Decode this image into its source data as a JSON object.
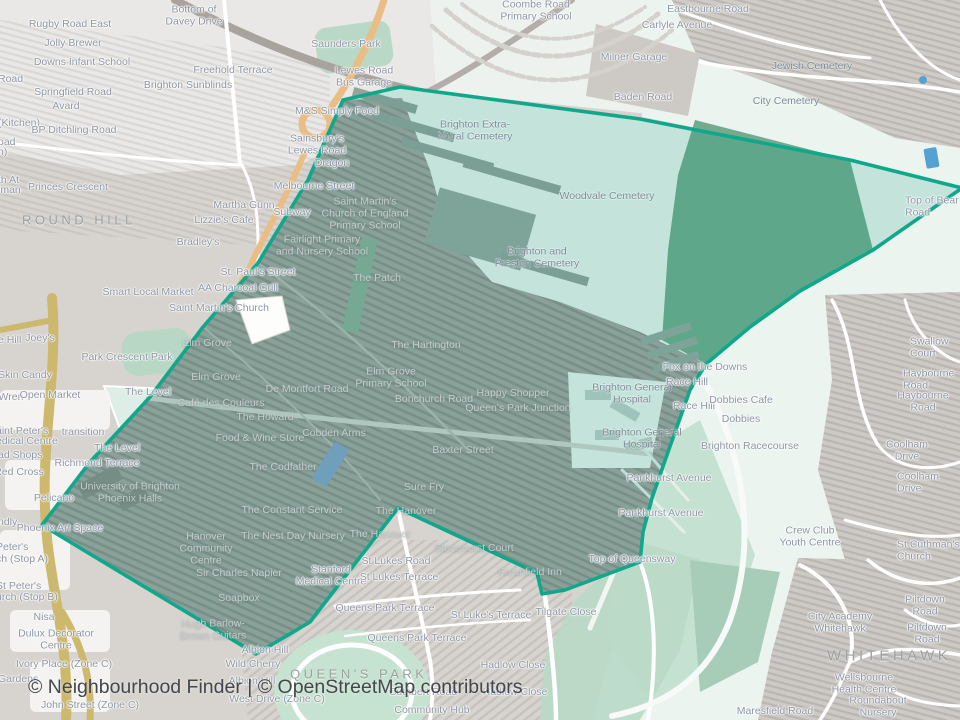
{
  "app": {
    "type": "neighbourhood-boundary-map",
    "attribution": "© Neighbourhood Finder | © OpenStreetMap contributors"
  },
  "colors": {
    "boundary_stroke": "#10a78b",
    "boundary_fill": "rgba(0,150,120,0.18)",
    "land_urban": "#d7d3cf",
    "land_open": "#ecf4f0",
    "woodland": "#74ab8e",
    "park_green": "#b9d9c6",
    "main_road_orange": "#e9bd83",
    "main_road_gold": "#cdb96d",
    "water_blue": "#6f9fba",
    "label_gray": "#8e96a3",
    "label_light": "#c6cdce",
    "attribution_text": "#43474b"
  },
  "map": {
    "district_labels": [
      {
        "t": "ROUND HILL",
        "x": 22,
        "y": 221,
        "c": "area",
        "a": "l"
      },
      {
        "t": "QUEEN'S PARK",
        "x": 290,
        "y": 675,
        "c": "area",
        "a": "l"
      },
      {
        "t": "WHITEHAWK",
        "x": 827,
        "y": 657,
        "c": "area",
        "a": "l",
        "s": 15
      }
    ],
    "labels": [
      {
        "t": "Rugby Road East",
        "x": 70,
        "y": 25
      },
      {
        "t": "Jolly Brewer",
        "x": 73,
        "y": 44
      },
      {
        "t": "Downs Infant School",
        "x": 82,
        "y": 63
      },
      {
        "t": "Road",
        "x": -2,
        "y": 80,
        "a": "l"
      },
      {
        "t": "Springfield Road",
        "x": 73,
        "y": 93
      },
      {
        "t": "Avard",
        "x": 66,
        "y": 107
      },
      {
        "t": "(Kitchen)",
        "x": -2,
        "y": 124,
        "a": "l"
      },
      {
        "t": "BP Ditchling Road",
        "x": 74,
        "y": 131
      },
      {
        "t": "oad",
        "x": -2,
        "y": 143,
        "a": "l"
      },
      {
        "t": "n)",
        "x": -2,
        "y": 153,
        "a": "l"
      },
      {
        "t": "th At",
        "x": -2,
        "y": 181,
        "a": "l"
      },
      {
        "t": "lman",
        "x": -2,
        "y": 191,
        "a": "l"
      },
      {
        "t": "Princes Crescent",
        "x": 68,
        "y": 188
      },
      {
        "t": "Bottom of\nDavey Drive",
        "x": 194,
        "y": 16
      },
      {
        "t": "Saunders Park",
        "x": 346,
        "y": 45
      },
      {
        "t": "Freehold Terrace",
        "x": 233,
        "y": 71
      },
      {
        "t": "Brighton Sunblinds",
        "x": 188,
        "y": 86
      },
      {
        "t": "Lewes Road\nBus Garage",
        "x": 364,
        "y": 77
      },
      {
        "t": "M&S Simply Food",
        "x": 337,
        "y": 112
      },
      {
        "t": "Sainsbury's\nLewes Road",
        "x": 317,
        "y": 145
      },
      {
        "t": "Dragon",
        "x": 332,
        "y": 164
      },
      {
        "t": "Melbourne Street",
        "x": 314,
        "y": 187
      },
      {
        "t": "Martha Gunn",
        "x": 244,
        "y": 206
      },
      {
        "t": "Subway",
        "x": 292,
        "y": 213
      },
      {
        "t": "Lizzie's Cafe",
        "x": 224,
        "y": 221
      },
      {
        "t": "Saint Martin's\nChurch of England\nPrimary School",
        "x": 365,
        "y": 214,
        "c": "lt"
      },
      {
        "t": "Fairlight Primary\nand Nursery School",
        "x": 322,
        "y": 246,
        "c": "lt"
      },
      {
        "t": "Coombe Road\nPrimary School",
        "x": 536,
        "y": 11
      },
      {
        "t": "Milner Garage",
        "x": 634,
        "y": 58
      },
      {
        "t": "Baden Road",
        "x": 643,
        "y": 98
      },
      {
        "t": "Eastbourne Road",
        "x": 708,
        "y": 10
      },
      {
        "t": "Carlyle Avenue",
        "x": 677,
        "y": 26
      },
      {
        "t": "Jewish Cemetery",
        "x": 812,
        "y": 67,
        "c": "cem"
      },
      {
        "t": "City Cemetery",
        "x": 786,
        "y": 102,
        "c": "cem"
      },
      {
        "t": "Top of Bear Road",
        "x": 905,
        "y": 207,
        "a": "l"
      },
      {
        "t": "Brighton Extra-\nMural Cemetery",
        "x": 475,
        "y": 131,
        "c": "cem"
      },
      {
        "t": "Woodvale Cemetery",
        "x": 607,
        "y": 197,
        "c": "cem"
      },
      {
        "t": "Brighton and\nPreston Cemetery",
        "x": 537,
        "y": 258,
        "c": "cem"
      },
      {
        "t": "Bradley's",
        "x": 198,
        "y": 243
      },
      {
        "t": "St. Paul's Street",
        "x": 258,
        "y": 273
      },
      {
        "t": "AA Charcoal Grill",
        "x": 238,
        "y": 289
      },
      {
        "t": "Saint Martin's Church",
        "x": 219,
        "y": 309
      },
      {
        "t": "Smart Local Market",
        "x": 148,
        "y": 293
      },
      {
        "t": "Joey's",
        "x": 40,
        "y": 339
      },
      {
        "t": "e Hill",
        "x": -2,
        "y": 341,
        "a": "l"
      },
      {
        "t": "Park Crescent Park",
        "x": 127,
        "y": 358
      },
      {
        "t": "Elm Grove",
        "x": 207,
        "y": 344,
        "c": "lt"
      },
      {
        "t": "Skin Candy",
        "x": 25,
        "y": 376
      },
      {
        "t": "Elm Grove",
        "x": 216,
        "y": 378,
        "c": "lt"
      },
      {
        "t": "Wren",
        "x": 11,
        "y": 398
      },
      {
        "t": "Open Market",
        "x": 50,
        "y": 396
      },
      {
        "t": "The Level",
        "x": 148,
        "y": 393
      },
      {
        "t": "De Montfort Road",
        "x": 307,
        "y": 390,
        "c": "lt"
      },
      {
        "t": "Café des Couleurs",
        "x": 221,
        "y": 404,
        "c": "lt"
      },
      {
        "t": "The Howard",
        "x": 265,
        "y": 418,
        "c": "lt"
      },
      {
        "t": "Food & Wine Store",
        "x": 260,
        "y": 439,
        "c": "lt"
      },
      {
        "t": "Cobden Arms",
        "x": 334,
        "y": 434,
        "c": "lt"
      },
      {
        "t": "transition",
        "x": 83,
        "y": 433
      },
      {
        "t": "The Level",
        "x": 117,
        "y": 449
      },
      {
        "t": "Richmond Terrace",
        "x": 97,
        "y": 464
      },
      {
        "t": "aint Peter's",
        "x": -4,
        "y": 432,
        "a": "l"
      },
      {
        "t": "edical Centre",
        "x": -4,
        "y": 442,
        "a": "l"
      },
      {
        "t": "ad Shops",
        "x": -2,
        "y": 456,
        "a": "l"
      },
      {
        "t": "Red Cross",
        "x": 19,
        "y": 473
      },
      {
        "t": "The Codfather",
        "x": 283,
        "y": 468,
        "c": "lt"
      },
      {
        "t": "The Patch",
        "x": 377,
        "y": 279,
        "c": "lt"
      },
      {
        "t": "The Hartington",
        "x": 426,
        "y": 346,
        "c": "lt"
      },
      {
        "t": "Elm Grove\nPrimary School",
        "x": 391,
        "y": 378,
        "c": "lt"
      },
      {
        "t": "Bonchurch Road",
        "x": 434,
        "y": 400,
        "c": "lt"
      },
      {
        "t": "Happy Shopper",
        "x": 513,
        "y": 394,
        "c": "lt"
      },
      {
        "t": "Queen's Park Junction",
        "x": 518,
        "y": 409,
        "c": "lt"
      },
      {
        "t": "Baxter Street",
        "x": 463,
        "y": 451,
        "c": "lt"
      },
      {
        "t": "Sure Fry",
        "x": 424,
        "y": 488,
        "c": "lt"
      },
      {
        "t": "Brighton General\nHospital",
        "x": 632,
        "y": 394,
        "c": "cem"
      },
      {
        "t": "Brighton General\nHospital",
        "x": 642,
        "y": 439,
        "c": "cem"
      },
      {
        "t": "Pankhurst Avenue",
        "x": 669,
        "y": 479
      },
      {
        "t": "Pankhurst Avenue",
        "x": 661,
        "y": 514
      },
      {
        "t": "Fox on the Downs",
        "x": 705,
        "y": 368
      },
      {
        "t": "Race Hill",
        "x": 687,
        "y": 383
      },
      {
        "t": "Race Hill",
        "x": 694,
        "y": 407
      },
      {
        "t": "Dobbies Cafe",
        "x": 741,
        "y": 401
      },
      {
        "t": "Dobbies",
        "x": 741,
        "y": 420
      },
      {
        "t": "Brighton Racecourse",
        "x": 750,
        "y": 447
      },
      {
        "t": "Swallow Court",
        "x": 910,
        "y": 348,
        "a": "l"
      },
      {
        "t": "Haybourne Road",
        "x": 903,
        "y": 380,
        "a": "l"
      },
      {
        "t": "Haybourne Road",
        "x": 923,
        "y": 402
      },
      {
        "t": "Coolham Drive",
        "x": 907,
        "y": 451
      },
      {
        "t": "Coolham Drive",
        "x": 897,
        "y": 483,
        "a": "l"
      },
      {
        "t": "Crew Club\nYouth Centre",
        "x": 810,
        "y": 537
      },
      {
        "t": "Top of Queensway",
        "x": 632,
        "y": 560
      },
      {
        "t": "St Cuthman's Church",
        "x": 897,
        "y": 551,
        "a": "l"
      },
      {
        "t": "Piltdown Road",
        "x": 925,
        "y": 606
      },
      {
        "t": "Piltdown Road",
        "x": 927,
        "y": 634
      },
      {
        "t": "City Academy\nWhitehawk",
        "x": 840,
        "y": 623
      },
      {
        "t": "Wellsbourne\nHealth Centre",
        "x": 864,
        "y": 684
      },
      {
        "t": "Roundabout Nursery",
        "x": 878,
        "y": 707
      },
      {
        "t": "Maresfield Road",
        "x": 775,
        "y": 712
      },
      {
        "t": "Hanover\nCommunity\nCentre",
        "x": 206,
        "y": 549,
        "c": "lt"
      },
      {
        "t": "Sir Charles Napier",
        "x": 239,
        "y": 574,
        "c": "lt"
      },
      {
        "t": "Soapbox",
        "x": 239,
        "y": 599,
        "c": "lt"
      },
      {
        "t": "The Constant Service",
        "x": 292,
        "y": 511,
        "c": "lt"
      },
      {
        "t": "The Nest Day Nursery",
        "x": 293,
        "y": 537,
        "c": "lt"
      },
      {
        "t": "The Hanover",
        "x": 406,
        "y": 512,
        "c": "lt"
      },
      {
        "t": "The Hanover",
        "x": 380,
        "y": 535,
        "c": "lt"
      },
      {
        "t": "Hugh Barlow-\nBrown Guitars",
        "x": 213,
        "y": 630,
        "c": "lt"
      },
      {
        "t": "Albion Hill",
        "x": 265,
        "y": 651
      },
      {
        "t": "Wild Cherry",
        "x": 253,
        "y": 665
      },
      {
        "t": "Albion Hill",
        "x": 252,
        "y": 682
      },
      {
        "t": "West Drive (Zone C)",
        "x": 277,
        "y": 700
      },
      {
        "t": "Stanford\nMedical Centre",
        "x": 331,
        "y": 576
      },
      {
        "t": "St Lukes Road",
        "x": 396,
        "y": 562
      },
      {
        "t": "St Lukes Terrace",
        "x": 399,
        "y": 578
      },
      {
        "t": "Stonehurst Court",
        "x": 474,
        "y": 549,
        "c": "lt"
      },
      {
        "t": "Freshfield Inn",
        "x": 530,
        "y": 573,
        "c": "lt"
      },
      {
        "t": "Queens Park Terrace",
        "x": 385,
        "y": 609
      },
      {
        "t": "Queens Park Terrace",
        "x": 417,
        "y": 639
      },
      {
        "t": "St Luke's Terrace",
        "x": 491,
        "y": 616
      },
      {
        "t": "Tilgate Close",
        "x": 566,
        "y": 613
      },
      {
        "t": "Hadlow Close",
        "x": 513,
        "y": 666
      },
      {
        "t": "Hadlow Close",
        "x": 515,
        "y": 693
      },
      {
        "t": "Cuthbert Road",
        "x": 423,
        "y": 693
      },
      {
        "t": "Community Hub",
        "x": 432,
        "y": 711
      },
      {
        "t": "University of Brighton\nPhoenix Halls",
        "x": 130,
        "y": 493,
        "c": "lt"
      },
      {
        "t": "Pelicano",
        "x": 54,
        "y": 499
      },
      {
        "t": "Phoenix Art Space",
        "x": 60,
        "y": 529
      },
      {
        "t": "ndly",
        "x": -2,
        "y": 523,
        "a": "l"
      },
      {
        "t": "Peter's",
        "x": -4,
        "y": 548,
        "a": "l"
      },
      {
        "t": "ch (Stop A)",
        "x": -4,
        "y": 560,
        "a": "l"
      },
      {
        "t": "St Peter's",
        "x": -4,
        "y": 587,
        "a": "l"
      },
      {
        "t": "urch (Stop B)",
        "x": -4,
        "y": 598,
        "a": "l"
      },
      {
        "t": "Nisa",
        "x": 44,
        "y": 618
      },
      {
        "t": "Dulux Decorator\nCentre",
        "x": 56,
        "y": 640
      },
      {
        "t": "Ivory Place (Zone C)",
        "x": 64,
        "y": 665
      },
      {
        "t": "Gardens",
        "x": -2,
        "y": 680,
        "a": "l"
      },
      {
        "t": "John Street (Zone C)",
        "x": 90,
        "y": 706
      }
    ]
  }
}
